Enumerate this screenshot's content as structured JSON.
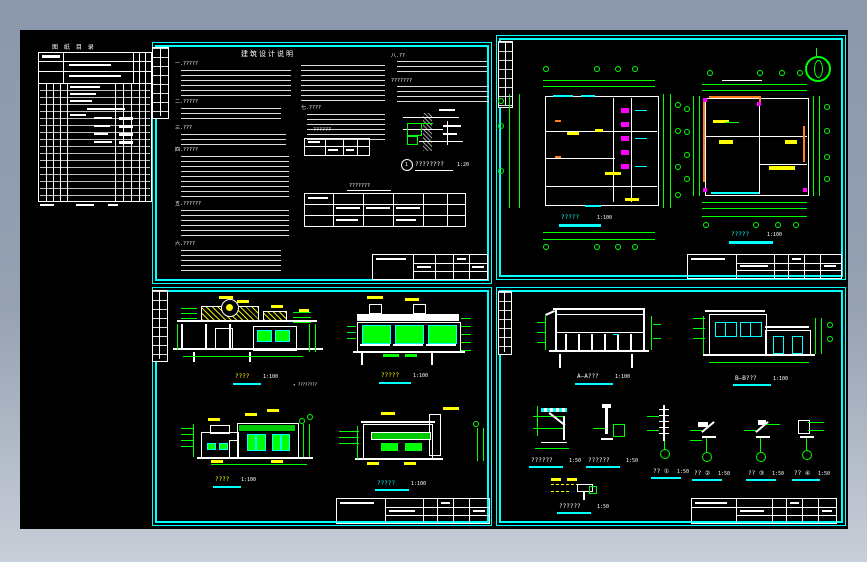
{
  "window": {
    "type": "cad-drawing-preview"
  },
  "palette": {
    "background_top": "#8b98ab",
    "background_bottom": "#c9cfd9",
    "canvas": "#000000",
    "sheet_frame": "#00ffff",
    "dimension": "#00ff00",
    "band_green": "#00c800",
    "accent_yellow": "#ffff00",
    "accent_magenta": "#ff00ff",
    "accent_orange": "#ff7f1e",
    "line": "#ffffff"
  },
  "drawing_list": {
    "title": "图 纸 目 录"
  },
  "notes": {
    "title": "建筑设计说明",
    "headings": [
      "一.?????",
      "二.?????",
      "三.???",
      "四.?????",
      "五.??????",
      "六.????"
    ],
    "col2_heading": "七.????",
    "col3_heading": "八.??",
    "col3_subheading": "???????",
    "schedule_caption": "??????",
    "detail_number": "1",
    "detail_caption": "????????",
    "detail_scale": "1:20",
    "finish_caption": "???????"
  },
  "captions": {
    "plan1": {
      "label": "?????",
      "scale": "1:100"
    },
    "plan2": {
      "label": "?????",
      "scale": "1:100"
    },
    "elev1": {
      "label": "????",
      "scale": "1:100"
    },
    "elev2": {
      "label": "?????",
      "scale": "1:100"
    },
    "elev3": {
      "label": "????",
      "scale": "1:100"
    },
    "elev4": {
      "label": "?????",
      "scale": "1:100"
    },
    "secA": {
      "label": "A—A???",
      "scale": "1:100"
    },
    "secB": {
      "label": "B—B???",
      "scale": "1:100"
    },
    "det1": {
      "label": "??????",
      "scale": "1:50"
    },
    "det2": {
      "label": "??????",
      "scale": "1:50"
    },
    "det3": {
      "label": "?? ①",
      "scale": "1:50"
    },
    "det4": {
      "label": "?? ②",
      "scale": "1:50"
    },
    "det5": {
      "label": "?? ③",
      "scale": "1:50"
    },
    "det6": {
      "label": "?? ④",
      "scale": "1:50"
    },
    "det7": {
      "label": "??????",
      "scale": "1:50"
    }
  },
  "elev_note": "+ ????????"
}
